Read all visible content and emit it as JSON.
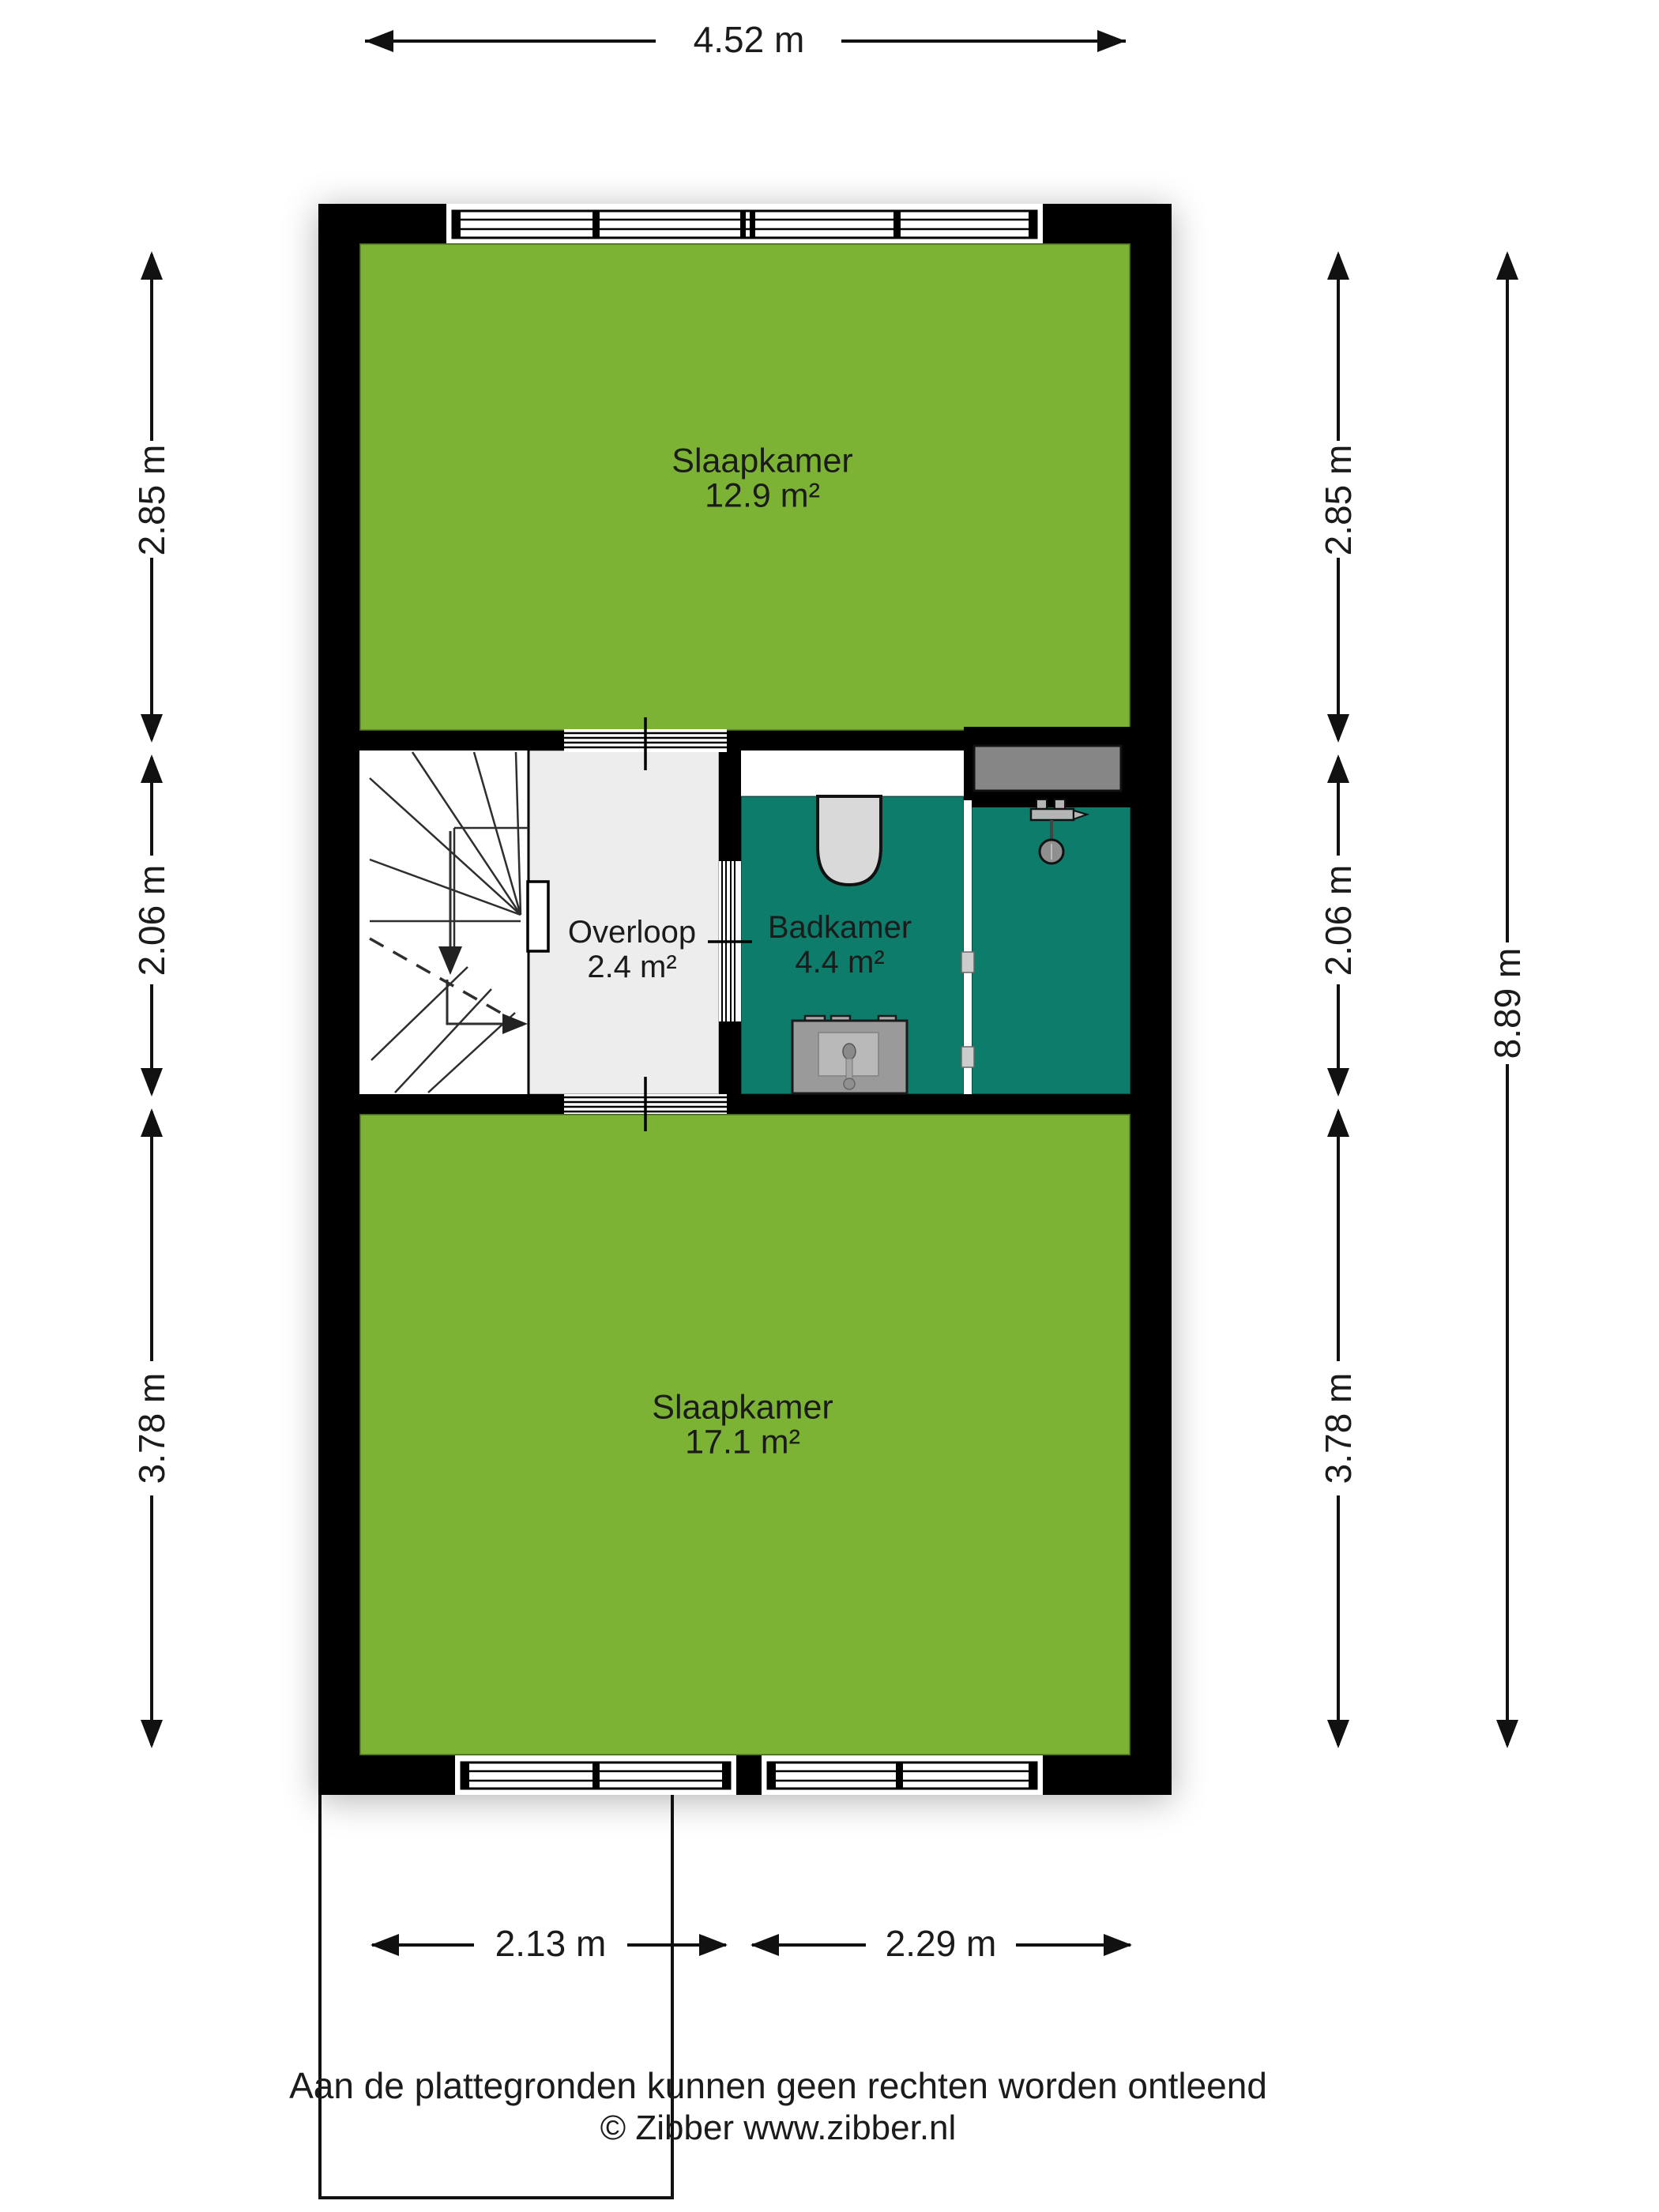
{
  "plan": {
    "type": "floorplan-first-floor",
    "rooms": {
      "bedroom_top": {
        "name": "Slaapkamer",
        "area": "12.9 m²"
      },
      "landing": {
        "name": "Overloop",
        "area": "2.4 m²"
      },
      "bathroom": {
        "name": "Badkamer",
        "area": "4.4 m²"
      },
      "bedroom_bottom": {
        "name": "Slaapkamer",
        "area": "17.1 m²"
      }
    },
    "fixtures": [
      "stairs",
      "toilet",
      "washbasin",
      "shower",
      "shelf",
      "doors",
      "windows"
    ],
    "colors": {
      "room_green": "#7cb334",
      "bathroom_teal": "#0d7c6b",
      "landing_grey": "#ededed",
      "wall_black": "#000000",
      "fixture_grey": "#d9d9d9"
    }
  },
  "dimensions": {
    "top": {
      "label": "4.52 m"
    },
    "left": [
      {
        "label": "2.85 m"
      },
      {
        "label": "2.06 m"
      },
      {
        "label": "3.78 m"
      }
    ],
    "right": [
      {
        "label": "2.85 m"
      },
      {
        "label": "2.06 m"
      },
      {
        "label": "3.78 m"
      }
    ],
    "right_total": {
      "label": "8.89 m"
    },
    "bottom": [
      {
        "label": "2.13 m"
      },
      {
        "label": "2.29 m"
      }
    ]
  },
  "footer": {
    "disclaimer": "Aan de plattegronden kunnen geen rechten worden ontleend",
    "copyright": "© Zibber www.zibber.nl"
  }
}
